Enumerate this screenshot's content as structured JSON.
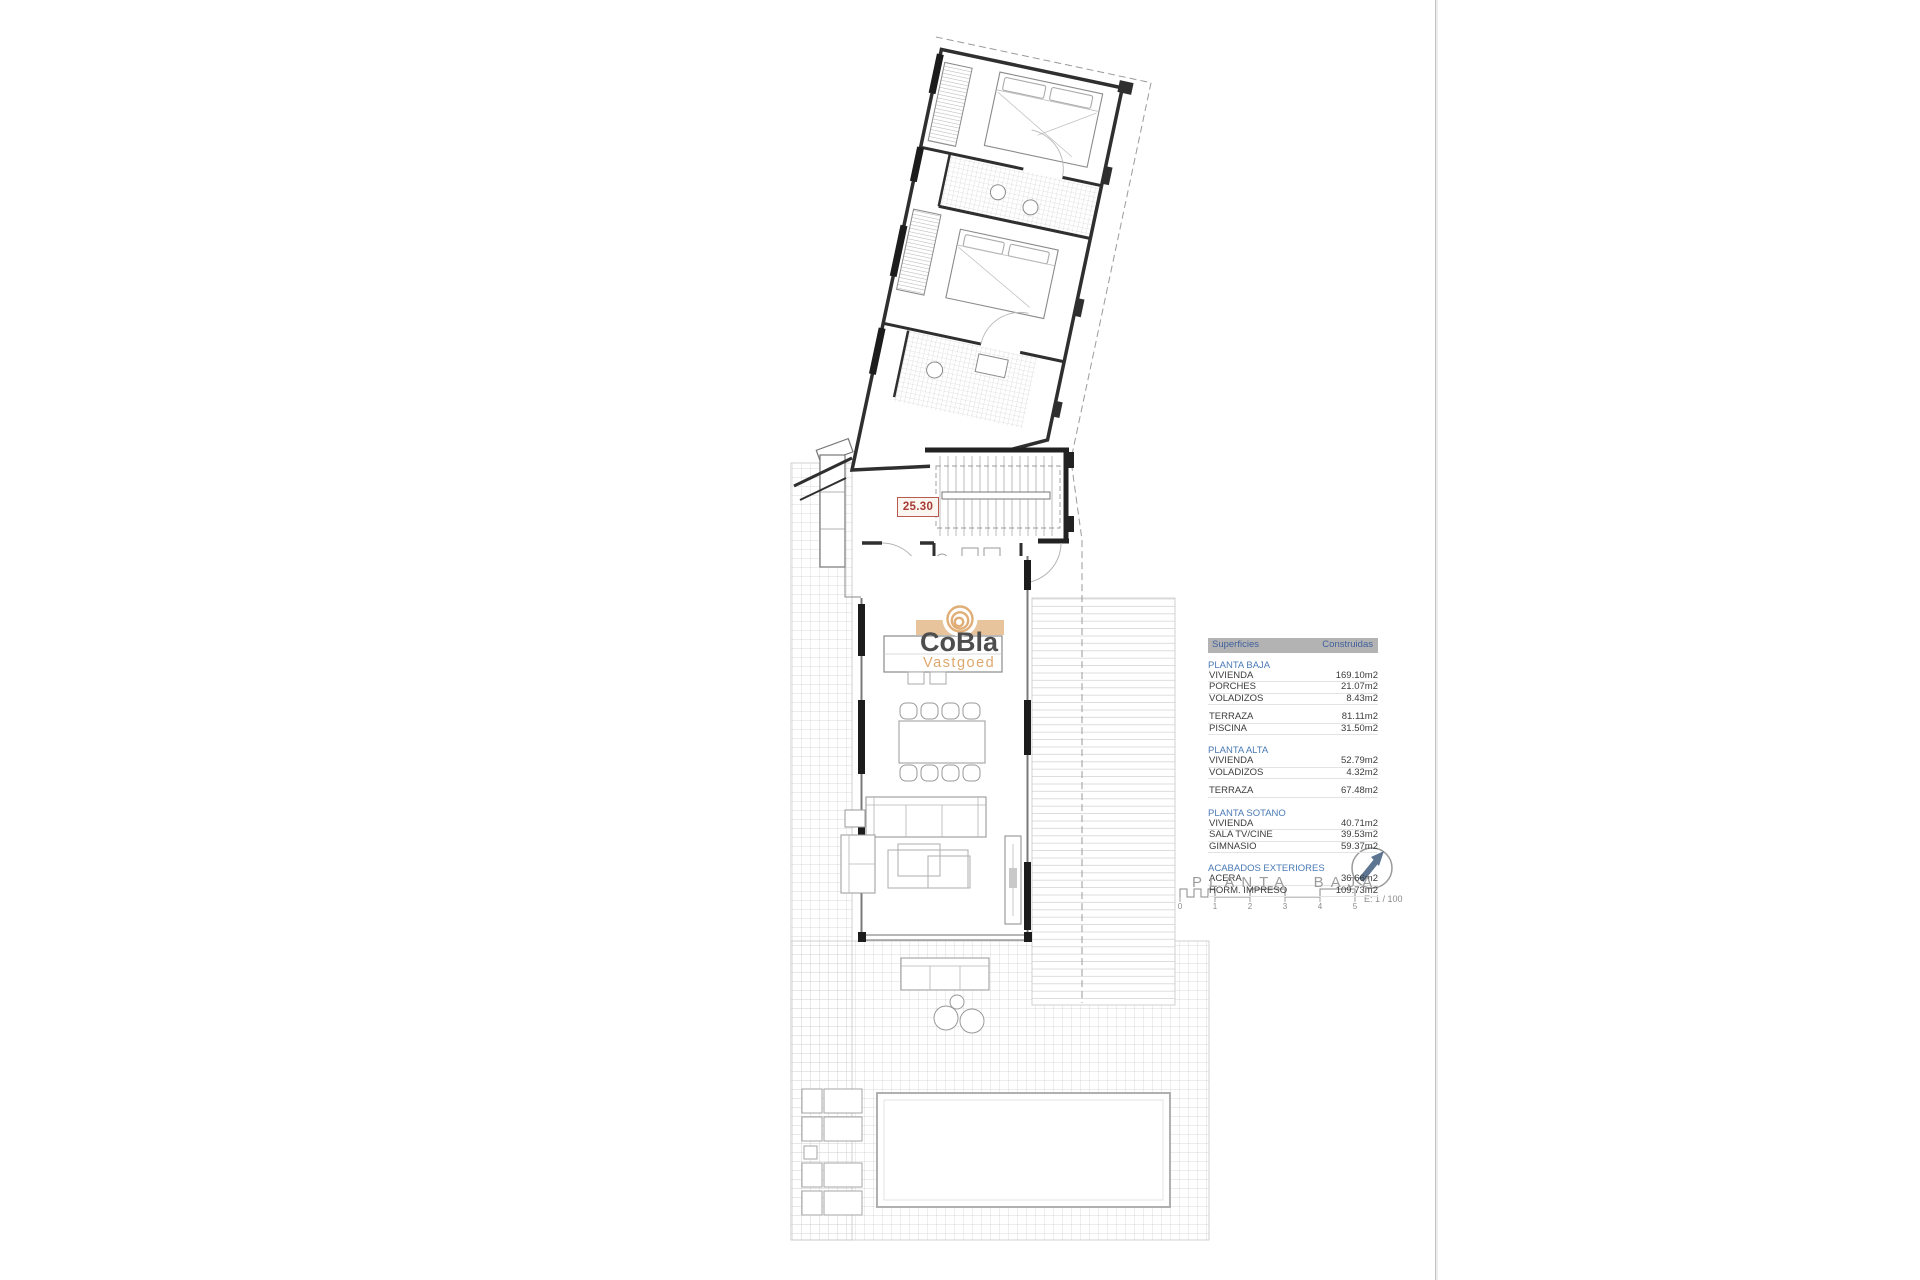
{
  "dimension_label": "25.30",
  "logo": {
    "name": "CoBla",
    "sub": "Vastgoed",
    "accent_color": "#dfa86e",
    "text_color": "#4e4e4e",
    "band_color": "#e4bc8e"
  },
  "areas_table": {
    "header": {
      "col1": "Superficies",
      "col2": "Construidas"
    },
    "header_bg": "#b3b3b3",
    "section_color": "#4a7ab5",
    "rows": [
      {
        "type": "section",
        "label": "PLANTA BAJA"
      },
      {
        "type": "row",
        "label": "VIVIENDA",
        "value": "169.10m2"
      },
      {
        "type": "row",
        "label": "PORCHES",
        "value": "21.07m2"
      },
      {
        "type": "row",
        "label": "VOLADIZOS",
        "value": "8.43m2"
      },
      {
        "type": "gap"
      },
      {
        "type": "row",
        "label": "TERRAZA",
        "value": "81.11m2"
      },
      {
        "type": "row",
        "label": "PISCINA",
        "value": "31.50m2"
      },
      {
        "type": "gap"
      },
      {
        "type": "section",
        "label": "PLANTA ALTA"
      },
      {
        "type": "row",
        "label": "VIVIENDA",
        "value": "52.79m2"
      },
      {
        "type": "row",
        "label": "VOLADIZOS",
        "value": "4.32m2"
      },
      {
        "type": "gap"
      },
      {
        "type": "row",
        "label": "TERRAZA",
        "value": "67.48m2"
      },
      {
        "type": "gap"
      },
      {
        "type": "section",
        "label": "PLANTA SOTANO"
      },
      {
        "type": "row",
        "label": "VIVIENDA",
        "value": "40.71m2"
      },
      {
        "type": "row",
        "label": "SALA TV/CINE",
        "value": "39.53m2"
      },
      {
        "type": "row",
        "label": "GIMNASIO",
        "value": "59.37m2"
      },
      {
        "type": "gap"
      },
      {
        "type": "section",
        "label": "ACABADOS EXTERIORES"
      },
      {
        "type": "row",
        "label": "ACERA",
        "value": "36.66m2"
      },
      {
        "type": "row",
        "label": "HORM. IMPRESO",
        "value": "109.73m2"
      }
    ]
  },
  "title_block": {
    "title": "PLANTA BAJA",
    "scale_label": "E: 1 / 100",
    "scale_ticks": [
      "0",
      "1",
      "2",
      "3",
      "4",
      "5"
    ]
  }
}
